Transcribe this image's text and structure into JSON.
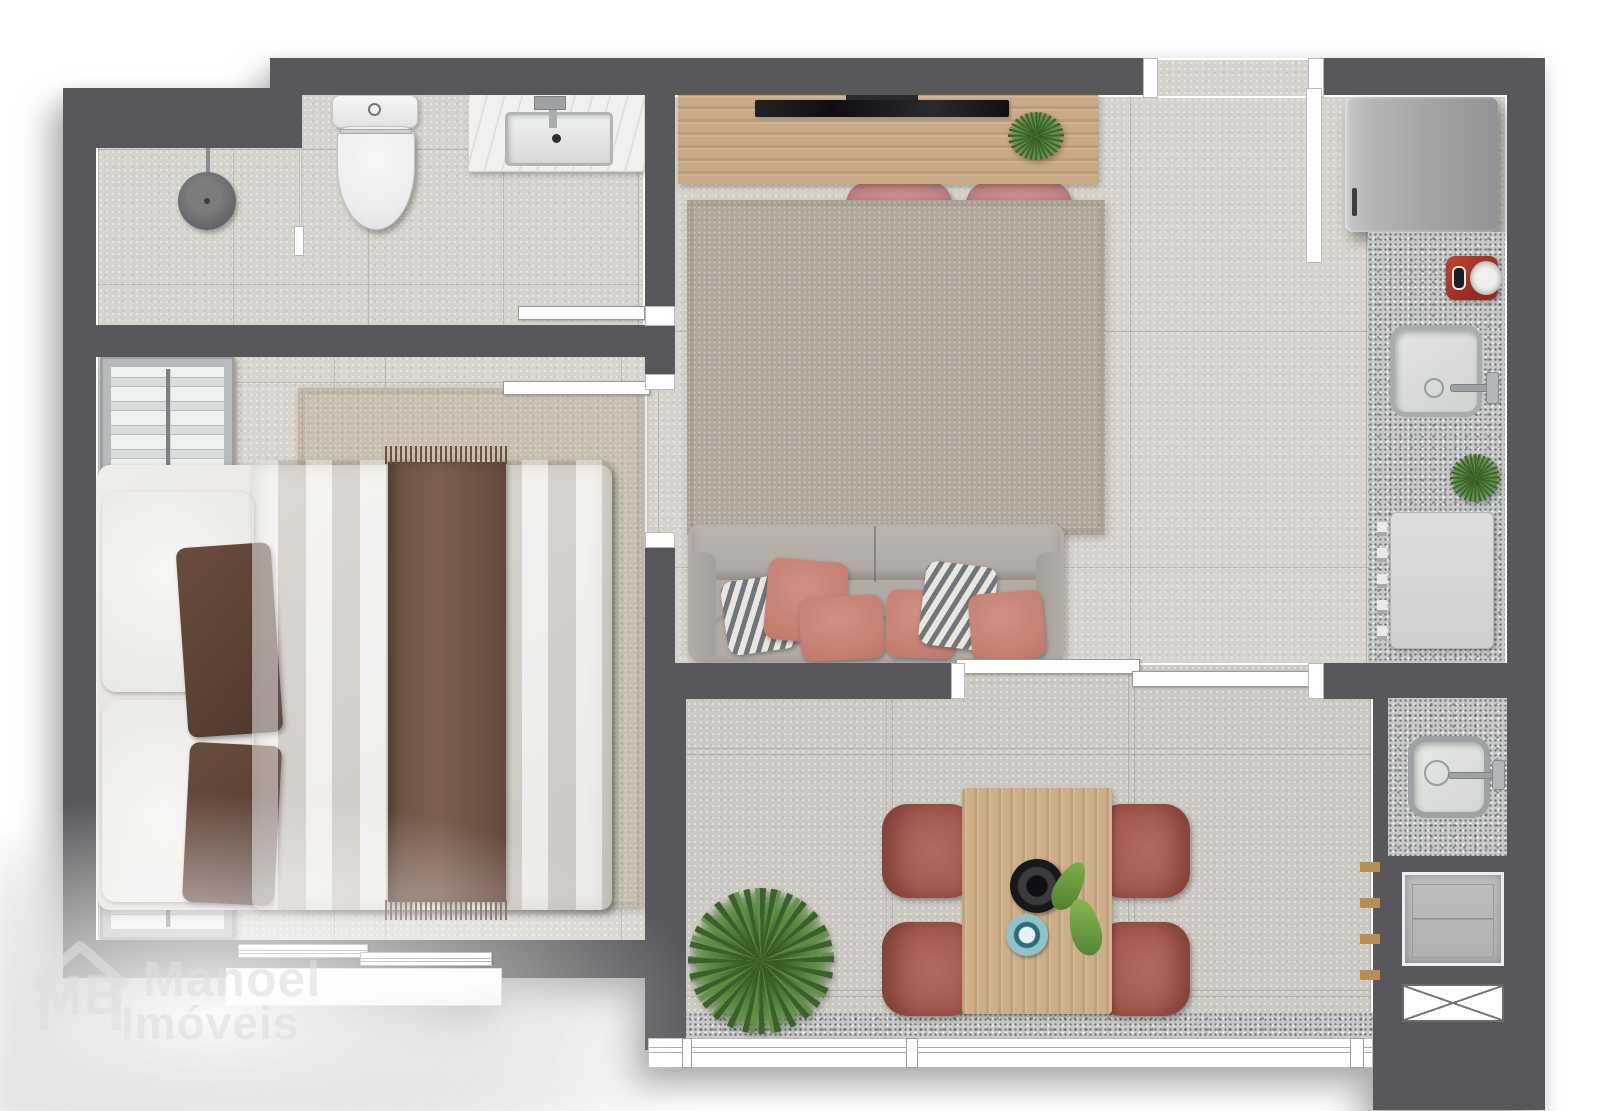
{
  "watermark": {
    "logo_initials": "MB",
    "brand_line1": "Manoel",
    "brand_line2": "Imóveis"
  },
  "plan": {
    "type": "apartment-floor-plan-render",
    "view": "top-down",
    "rooms": [
      {
        "name": "bathroom",
        "items": [
          "shower-drain",
          "shower-glass-partition",
          "toilet",
          "vanity-sink",
          "sliding-door"
        ]
      },
      {
        "name": "bedroom",
        "items": [
          "wardrobe-upper",
          "double-bed",
          "white-pillows",
          "brown-pillows",
          "throw-blanket",
          "area-rug",
          "wardrobe-lower",
          "window",
          "sliding-door"
        ]
      },
      {
        "name": "living-room",
        "items": [
          "tv-console",
          "tv",
          "console-plant",
          "desk-chair",
          "desk-chair",
          "area-rug",
          "sofa",
          "throw-pillows"
        ]
      },
      {
        "name": "kitchen",
        "items": [
          "refrigerator",
          "granite-counter",
          "red-coffee-maker",
          "sink",
          "counter-plant",
          "gas-cooktop",
          "entry-opening"
        ]
      },
      {
        "name": "balcony-dining",
        "items": [
          "palm-plant",
          "dining-table",
          "dining-chair",
          "dining-chair",
          "dining-chair",
          "dining-chair",
          "black-bowl",
          "teal-plate",
          "leaf-decor",
          "sliding-glass-door",
          "glass-railing"
        ]
      },
      {
        "name": "laundry",
        "items": [
          "granite-counter",
          "laundry-sink",
          "washing-machine",
          "duct-shaft"
        ]
      }
    ],
    "colors": {
      "wall": "#58585c",
      "floor": "#d6d3cd",
      "balcony_floor": "#ccc9c3",
      "granite": "#c7c9c9",
      "wood": "#c9aa84",
      "rose_chair": "#ba7e80",
      "terracotta_chair": "#a2554b",
      "sofa": "#b2aca5",
      "salmon_pillow": "#c47e70",
      "plant_green": "#4c7a31",
      "appliance_red": "#a93226",
      "plate_teal": "#7ab6bf"
    }
  }
}
